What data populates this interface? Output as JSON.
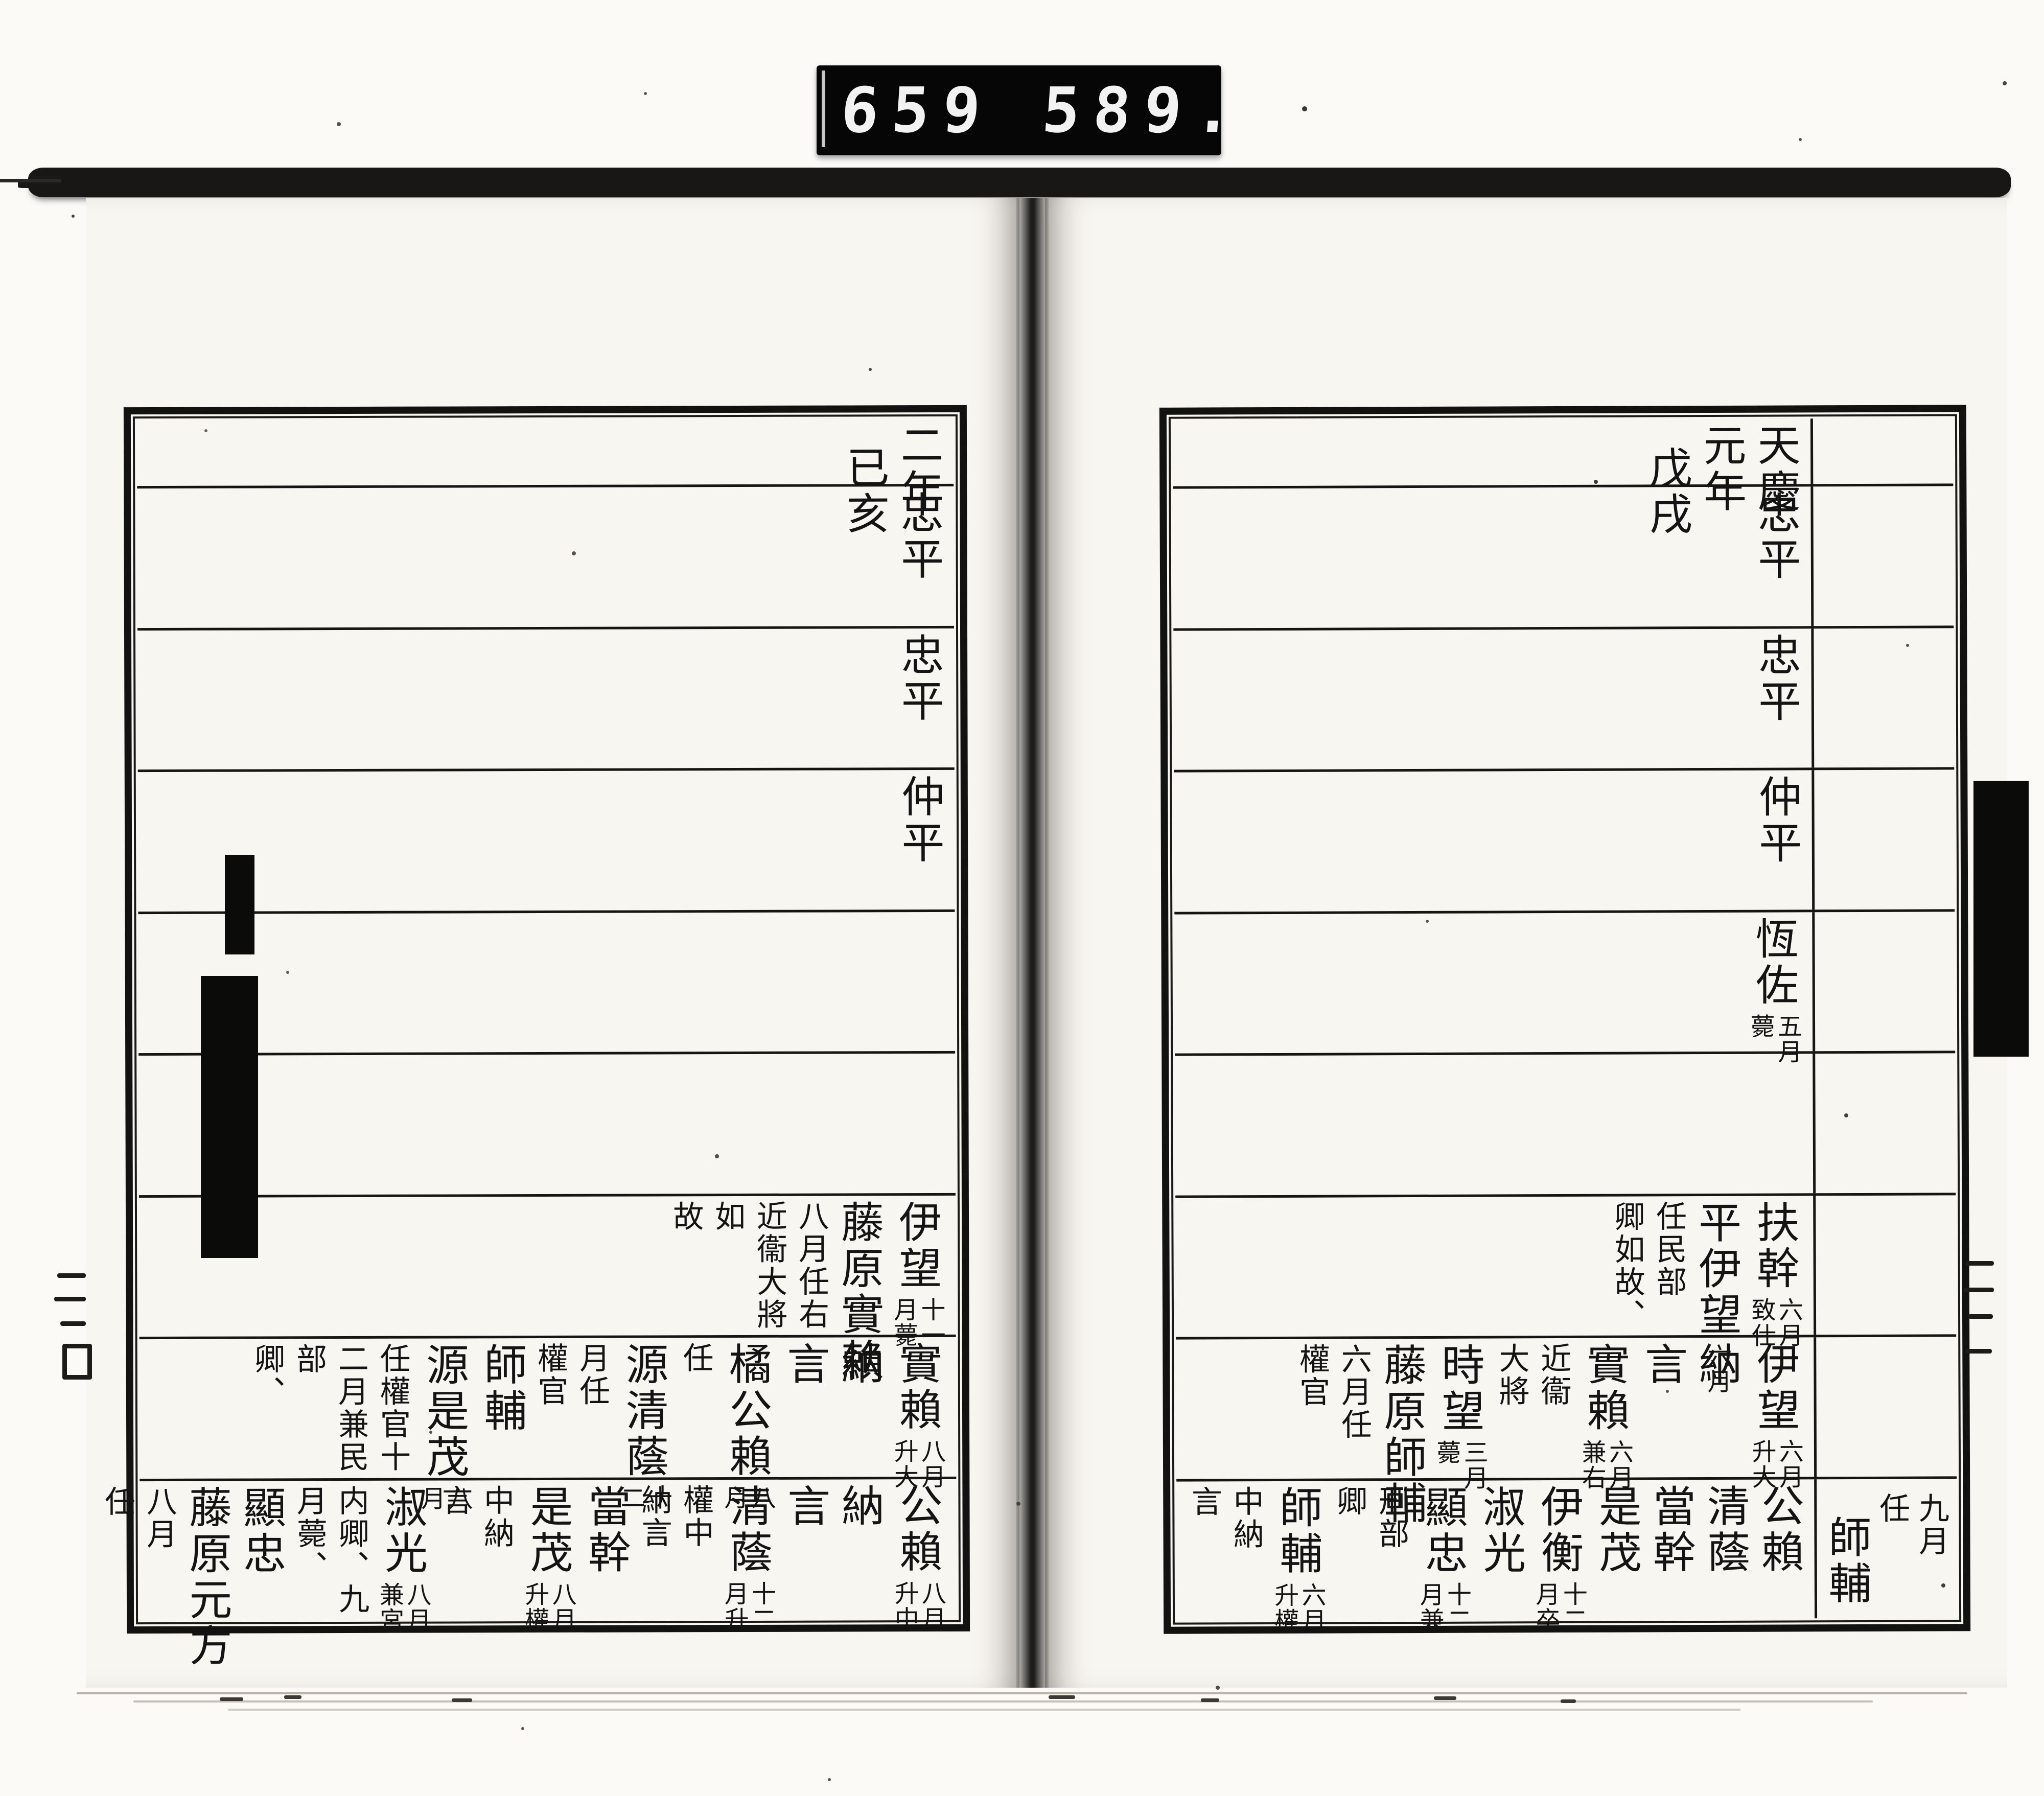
{
  "counter": {
    "left": "659",
    "right": "589."
  },
  "ink": "#141414",
  "paper": "#f8f6f1",
  "pages": {
    "left": {
      "header": {
        "cols": [
          {
            "t": "二年",
            "k": "nm"
          },
          {
            "t": "已亥",
            "k": "nm",
            "drop": 1
          }
        ]
      },
      "rows": [
        [
          {
            "t": "忠平",
            "k": "nm"
          }
        ],
        [
          {
            "t": "忠平",
            "k": "nm"
          }
        ],
        [
          {
            "t": "仲平",
            "k": "nm"
          }
        ],
        [],
        [],
        [
          {
            "t": "伊望",
            "k": "nm",
            "nr": "十一",
            "nl": "月薨"
          },
          {
            "t": "藤原實賴",
            "k": "nm"
          },
          {
            "t": "八月任右",
            "k": "mid"
          },
          {
            "t": "近衞大將",
            "k": "mid"
          },
          {
            "t": "如",
            "k": "mid"
          },
          {
            "t": "故",
            "k": "mid"
          }
        ],
        [
          {
            "t": "實賴",
            "k": "nm",
            "nr": "八月",
            "nl": "升大"
          },
          {
            "t": "納",
            "k": "nm"
          },
          {
            "t": "言",
            "k": "nm"
          },
          {
            "t": "橘公賴",
            "k": "nm",
            "nr": "八",
            "nl": "月"
          },
          {
            "t": "任",
            "k": "mid"
          },
          {
            "t": "源清蔭",
            "k": "nm",
            "nr": "十",
            "nl": "二"
          },
          {
            "t": "月任",
            "k": "mid"
          },
          {
            "t": "權官",
            "k": "mid"
          },
          {
            "t": "師輔",
            "k": "nm"
          },
          {
            "t": "源是茂",
            "k": "nm",
            "nr": "八",
            "nl": "月"
          },
          {
            "t": "任權官十",
            "k": "mid"
          },
          {
            "t": "二月兼民",
            "k": "mid"
          },
          {
            "t": "部",
            "k": "mid"
          },
          {
            "t": "卿、",
            "k": "mid"
          }
        ],
        [
          {
            "t": "公賴",
            "k": "nm",
            "nr": "八月",
            "nl": "升中"
          },
          {
            "t": "納",
            "k": "nm"
          },
          {
            "t": "言",
            "k": "nm"
          },
          {
            "t": "清蔭",
            "k": "nm",
            "nr": "十二",
            "nl": "月升"
          },
          {
            "t": "權中",
            "k": "mid"
          },
          {
            "t": "納言",
            "k": "mid"
          },
          {
            "t": "當幹",
            "k": "nm"
          },
          {
            "t": "是茂",
            "k": "nm",
            "nr": "八月",
            "nl": "升權"
          },
          {
            "t": "中納",
            "k": "mid"
          },
          {
            "t": "言",
            "k": "mid"
          },
          {
            "t": "淑光",
            "k": "nm",
            "nr": "八月",
            "nl": "兼宮"
          },
          {
            "t": "内卿、九",
            "k": "mid"
          },
          {
            "t": "月薨、",
            "k": "mid"
          },
          {
            "t": "顯忠",
            "k": "nm"
          },
          {
            "t": "藤原元方",
            "k": "nm"
          },
          {
            "t": "八月",
            "k": "mid"
          },
          {
            "t": "任",
            "k": "mid"
          }
        ]
      ]
    },
    "right": {
      "header": {
        "cols": [
          {
            "t": "天慶",
            "k": "nm"
          },
          {
            "t": "元年",
            "k": "nm"
          },
          {
            "t": "戊戌",
            "k": "nm",
            "drop": 1
          }
        ]
      },
      "prev_column_rows": {
        "7": [
          {
            "t": "九月",
            "k": "mid"
          },
          {
            "t": "任",
            "k": "mid"
          },
          {
            "t": "師輔",
            "k": "nm",
            "drop": 1
          }
        ]
      },
      "rows": [
        [
          {
            "t": "忠平",
            "k": "nm"
          }
        ],
        [
          {
            "t": "忠平",
            "k": "nm"
          }
        ],
        [
          {
            "t": "仲平",
            "k": "nm"
          }
        ],
        [
          {
            "t": "恆佐",
            "k": "nm",
            "nr": "五月",
            "nl": "薨"
          }
        ],
        [],
        [
          {
            "t": "扶幹",
            "k": "nm",
            "nr": "六月",
            "nl": "致仕"
          },
          {
            "t": "平伊望",
            "k": "nm",
            "nr": "六月",
            "nl": ""
          },
          {
            "t": "任民部",
            "k": "mid"
          },
          {
            "t": "卿如故、",
            "k": "mid"
          }
        ],
        [
          {
            "t": "伊望",
            "k": "nm",
            "nr": "六月",
            "nl": "升大"
          },
          {
            "t": "納",
            "k": "nm"
          },
          {
            "t": "言",
            "k": "nm"
          },
          {
            "t": "實賴",
            "k": "nm",
            "nr": "六月",
            "nl": "兼右"
          },
          {
            "t": "近衞",
            "k": "mid"
          },
          {
            "t": "大將",
            "k": "mid"
          },
          {
            "t": "時望",
            "k": "nm",
            "nr": "三月",
            "nl": "薨"
          },
          {
            "t": "藤原師輔",
            "k": "nm"
          },
          {
            "t": "六月任",
            "k": "mid"
          },
          {
            "t": "權官",
            "k": "mid"
          }
        ],
        [
          {
            "t": "公賴",
            "k": "nm"
          },
          {
            "t": "清蔭",
            "k": "nm"
          },
          {
            "t": "當幹",
            "k": "nm"
          },
          {
            "t": "是茂",
            "k": "nm"
          },
          {
            "t": "伊衡",
            "k": "nm",
            "nr": "十二",
            "nl": "月卒"
          },
          {
            "t": "淑光",
            "k": "nm"
          },
          {
            "t": "顯忠",
            "k": "nm",
            "nr": "十二",
            "nl": "月兼"
          },
          {
            "t": "刑部",
            "k": "mid"
          },
          {
            "t": "卿",
            "k": "mid"
          },
          {
            "t": "師輔",
            "k": "nm",
            "nr": "六月",
            "nl": "升權"
          },
          {
            "t": "中納",
            "k": "mid"
          },
          {
            "t": "言",
            "k": "mid"
          }
        ]
      ]
    }
  }
}
